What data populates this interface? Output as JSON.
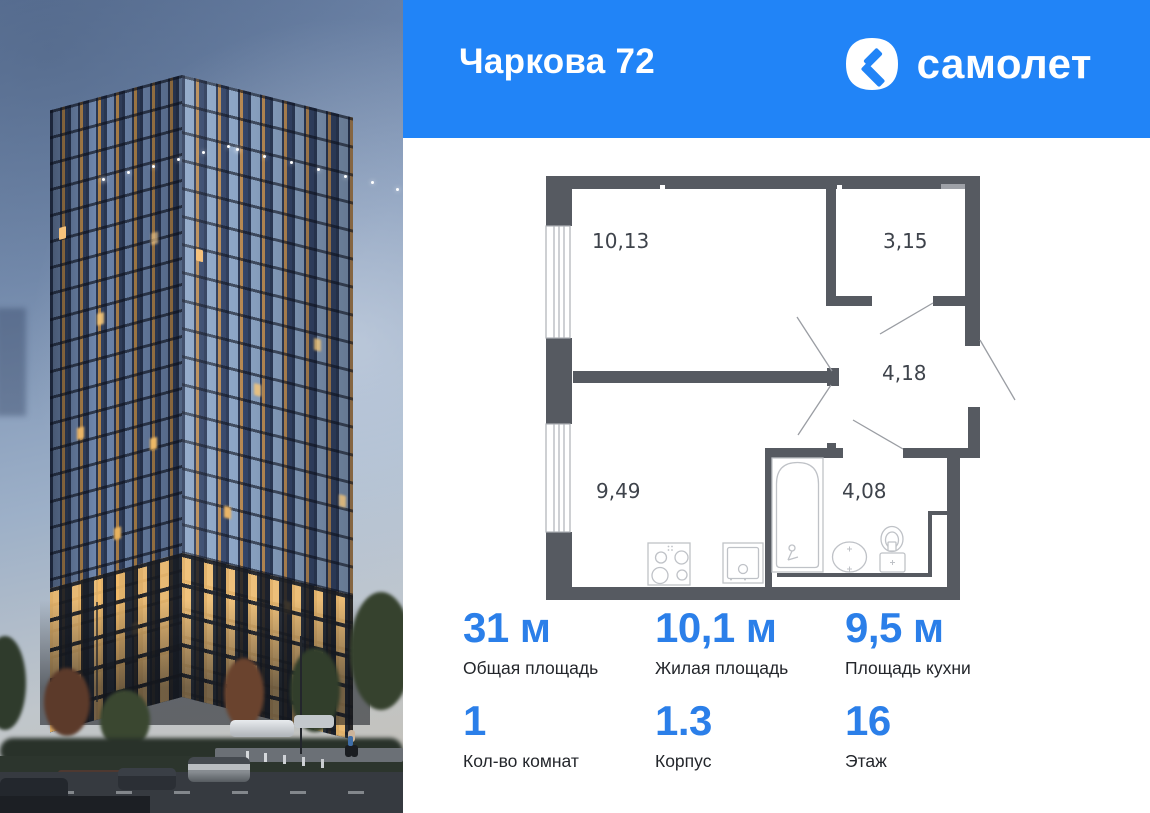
{
  "header": {
    "title": "Чаркова 72",
    "brand_text": "самолет",
    "bg_color": "#2184f7"
  },
  "plan": {
    "wall_color": "#565a61",
    "room_labels": {
      "living": "10,13",
      "storage": "3,15",
      "hall": "4,18",
      "kitchen": "9,49",
      "bath": "4,08"
    },
    "icons": [
      "stove-icon",
      "kitchen-sink-icon",
      "bathtub-icon",
      "washbasin-icon",
      "toilet-icon",
      "window",
      "door-swing"
    ]
  },
  "stats": {
    "accent_color": "#2b7fe9",
    "items": [
      {
        "value": "31 м",
        "label": "Общая площадь"
      },
      {
        "value": "10,1 м",
        "label": "Жилая площадь"
      },
      {
        "value": "9,5 м",
        "label": "Площадь кухни"
      },
      {
        "value": "1",
        "label": "Кол-во комнат"
      },
      {
        "value": "1.3",
        "label": "Корпус"
      },
      {
        "value": "16",
        "label": "Этаж"
      }
    ]
  }
}
